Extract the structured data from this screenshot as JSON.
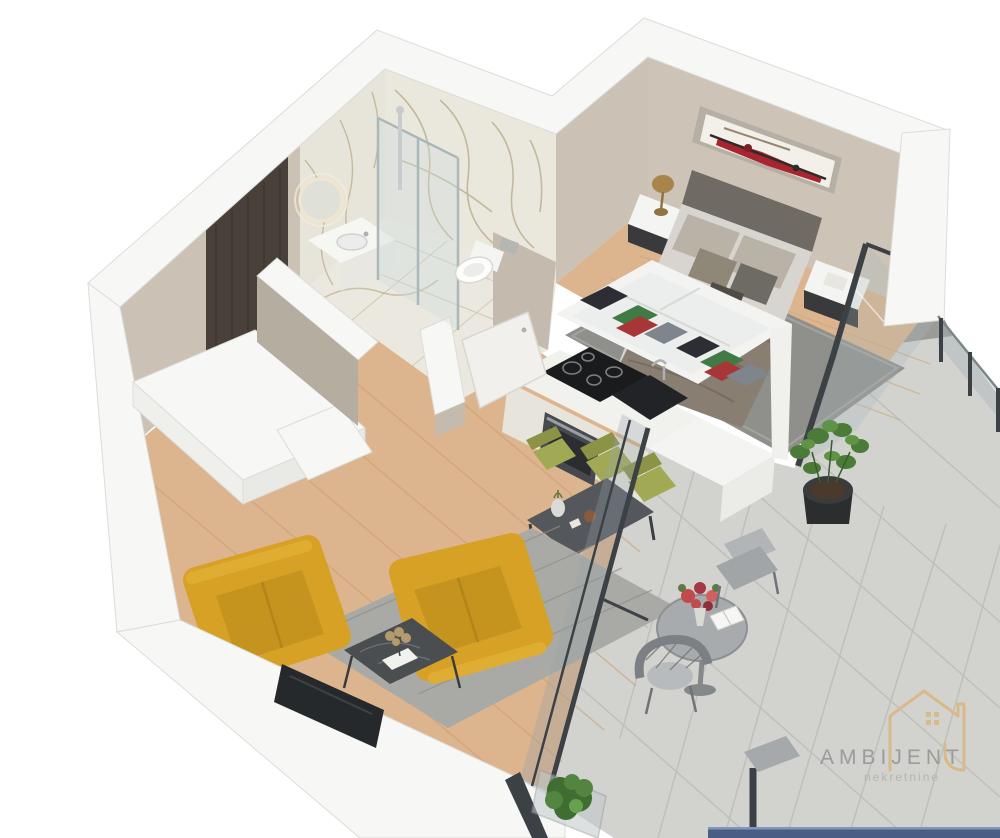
{
  "logo": {
    "brand": "AMBIJENT",
    "tagline": "nekretnine",
    "icon": "house-outline-icon",
    "brand_color": "#9b9b9b",
    "tagline_color": "#b4b4b4",
    "icon_color": "#d9b98a"
  },
  "bottom_bar": {
    "color": "#4a5d85",
    "highlight": "#8296bd"
  },
  "palette": {
    "background": "#ffffff",
    "wall_crown": "#f7f7f5",
    "wall_edge": "#dcdcd8",
    "wall_beige": "#cbc2b5",
    "wall_beige_dark": "#b5ada0",
    "marble_base": "#eae8df",
    "marble_vein": "#a89a6e",
    "wood_floor": "#dcb48e",
    "wood_plank": "#c79e74",
    "balcony_tile": "#d2d3cf",
    "tile_line": "#b9bab6",
    "entrance_door": "#4a403a",
    "sofa_yellow": "#d7a125",
    "chair_olive": "#a2a955",
    "table_dark": "#54575b",
    "rug_gray": "#8f8f8b",
    "bed_blanket": "#897e72",
    "tv_black": "#26292c",
    "plant_green": "#4c7a38",
    "flower_red": "#c14a4a",
    "glass_frame": "#3c4145"
  },
  "scene": {
    "type": "isometric 3D floor plan render",
    "unit": "studio apartment",
    "rooms": [
      {
        "name": "Bathroom",
        "items": [
          "marble tiled walls",
          "glass walk-in shower",
          "round backlit mirror",
          "white vanity sink",
          "wall-hung toilet",
          "open white door"
        ]
      },
      {
        "name": "Entry Hall",
        "items": [
          "dark wood entrance door",
          "white closet block",
          "wood flooring"
        ]
      },
      {
        "name": "Bedroom",
        "items": [
          "double bed with taupe bedding",
          "upholstered headboard",
          "abstract red-black wall art",
          "left nightstand with gold lamp",
          "right nightstand with book",
          "gray rug",
          "glass wall to balcony"
        ]
      },
      {
        "name": "Kitchen",
        "items": [
          "black induction cooktop",
          "built-in oven",
          "black sink",
          "cream cabinets",
          "white peninsula",
          "open storage with folded linens"
        ]
      },
      {
        "name": "Dining Area",
        "items": [
          "dark gray dining table",
          "olive green chairs",
          "flower vase decor"
        ]
      },
      {
        "name": "Living Room",
        "items": [
          "two mustard yellow loveseats",
          "dark coffee table with flowers and books",
          "gray rug",
          "flat screen TV on half wall"
        ]
      },
      {
        "name": "Balcony",
        "items": [
          "large gray floor tiles",
          "glass railing with dark posts",
          "potted green plant",
          "round bistro table with red bouquet and open book",
          "two gray outdoor chairs",
          "glass planter box with shrub"
        ]
      }
    ]
  }
}
